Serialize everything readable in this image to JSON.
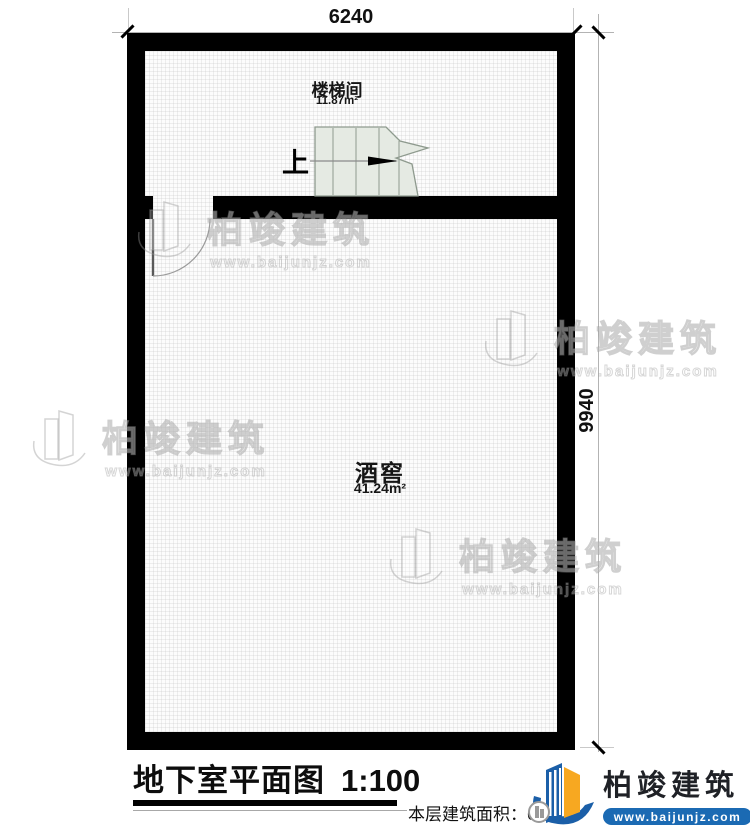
{
  "dimensions": {
    "top": "6240",
    "right": "9940"
  },
  "rooms": {
    "stairwell": {
      "name": "楼梯间",
      "area": "11.87m²"
    },
    "wine_cellar": {
      "name": "酒窖",
      "area": "41.24m²"
    }
  },
  "stairs": {
    "direction_label": "上"
  },
  "watermark": {
    "name": "柏竣建筑",
    "url": "www.baijunjz.com",
    "icon": "building-swoosh-icon"
  },
  "title_block": {
    "title": "地下室平面图",
    "scale": "1:100",
    "area_label": "本层建筑面积：62.",
    "area_obscured_digit": "3"
  },
  "logo": {
    "name": "柏竣建筑",
    "url": "www.baijunjz.com",
    "icon": "building-swoosh-icon"
  },
  "colors": {
    "wall": "#000000",
    "stair_fill": "#e5eae3",
    "stair_line": "#8e9a8e",
    "logo_blue": "#1b5fa8",
    "logo_orange": "#f7a821",
    "url_bar_blue": "#1b6ab3"
  }
}
